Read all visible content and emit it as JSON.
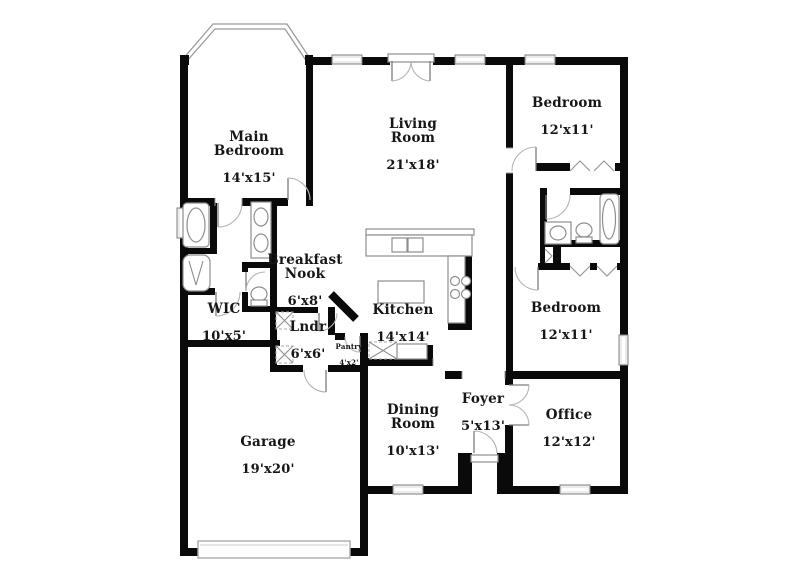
{
  "page": {
    "background": "#ffffff",
    "wall_color": "#0a0a0a",
    "fixture_color": "#8e8e8e"
  },
  "floorplan": {
    "rooms": {
      "main_bedroom": {
        "name": "Main\nBedroom",
        "dims": "14'x15'"
      },
      "living_room": {
        "name": "Living\nRoom",
        "dims": "21'x18'"
      },
      "bedroom_top": {
        "name": "Bedroom",
        "dims": "12'x11'"
      },
      "bedroom_mid": {
        "name": "Bedroom",
        "dims": "12'x11'"
      },
      "breakfast_nook": {
        "name": "Breakfast\nNook",
        "dims": "6'x8'"
      },
      "kitchen": {
        "name": "Kitchen",
        "dims": "14'x14'"
      },
      "wic": {
        "name": "WIC",
        "dims": "10'x5'"
      },
      "laundry": {
        "name": "Lndr",
        "dims": "6'x6'"
      },
      "pantry": {
        "name": "Pantry",
        "dims": "4'x2'"
      },
      "garage": {
        "name": "Garage",
        "dims": "19'x20'"
      },
      "dining_room": {
        "name": "Dining\nRoom",
        "dims": "10'x13'"
      },
      "foyer": {
        "name": "Foyer",
        "dims": "5'x13'"
      },
      "office": {
        "name": "Office",
        "dims": "12'x12'"
      }
    }
  }
}
